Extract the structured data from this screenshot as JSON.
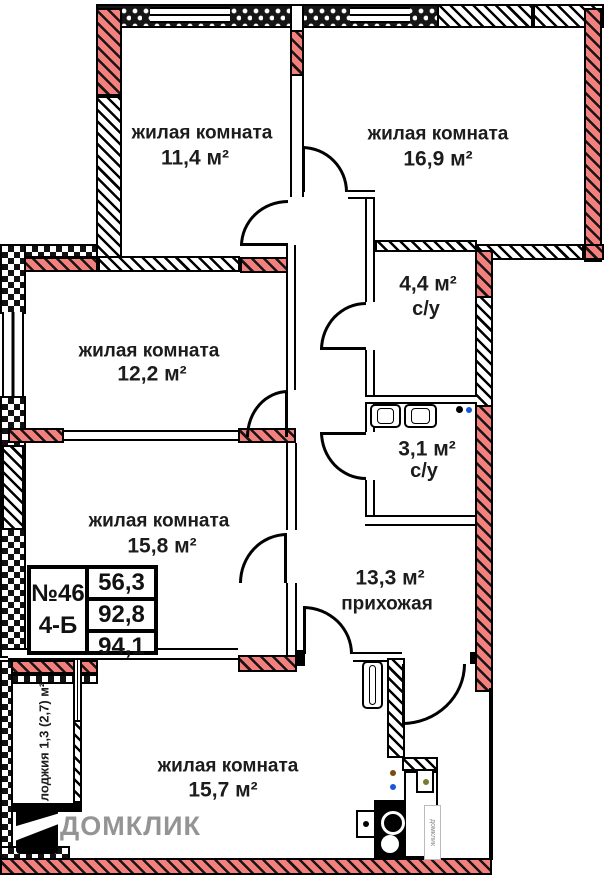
{
  "title": "План квартиры №46 4-Б",
  "rooms": [
    {
      "id": "living-1",
      "name": "жилая комната",
      "area": "11,4 м²"
    },
    {
      "id": "living-2",
      "name": "жилая комната",
      "area": "16,9 м²"
    },
    {
      "id": "living-3",
      "name": "жилая комната",
      "area": "12,2 м²"
    },
    {
      "id": "bathroom-1",
      "name": "с/у",
      "area": "4,4 м²"
    },
    {
      "id": "bathroom-2",
      "name": "с/у",
      "area": "3,1 м²"
    },
    {
      "id": "living-4",
      "name": "жилая комната",
      "area": "15,8 м²"
    },
    {
      "id": "hallway",
      "name": "прихожая",
      "area": "13,3 м²"
    },
    {
      "id": "living-5",
      "name": "жилая комната",
      "area": "15,7 м²"
    },
    {
      "id": "loggia",
      "name": "лоджия 1,3 (2,7) м²"
    }
  ],
  "info_box": {
    "number": "№46",
    "unit": "4-Б",
    "areas": [
      "56,3",
      "92,8",
      "94,1"
    ]
  },
  "watermark": {
    "text": "ДОМКЛИК",
    "vertical_text": "домклик"
  },
  "colors": {
    "wall_highlight": "#f4807e",
    "line": "#111111",
    "label_text": "#1c1c1c",
    "watermark_gray": "#949494"
  },
  "icons": {
    "logo": "domklik-house-logo-icon",
    "door": "door-arc-icon",
    "stove": "stove-burners-icon",
    "oven": "oven-icon",
    "sink": "sink-icon",
    "washing_machine": "washing-machine-icon",
    "radiator": "radiator-icon",
    "plumbing_point": "plumbing-dot-icon"
  }
}
